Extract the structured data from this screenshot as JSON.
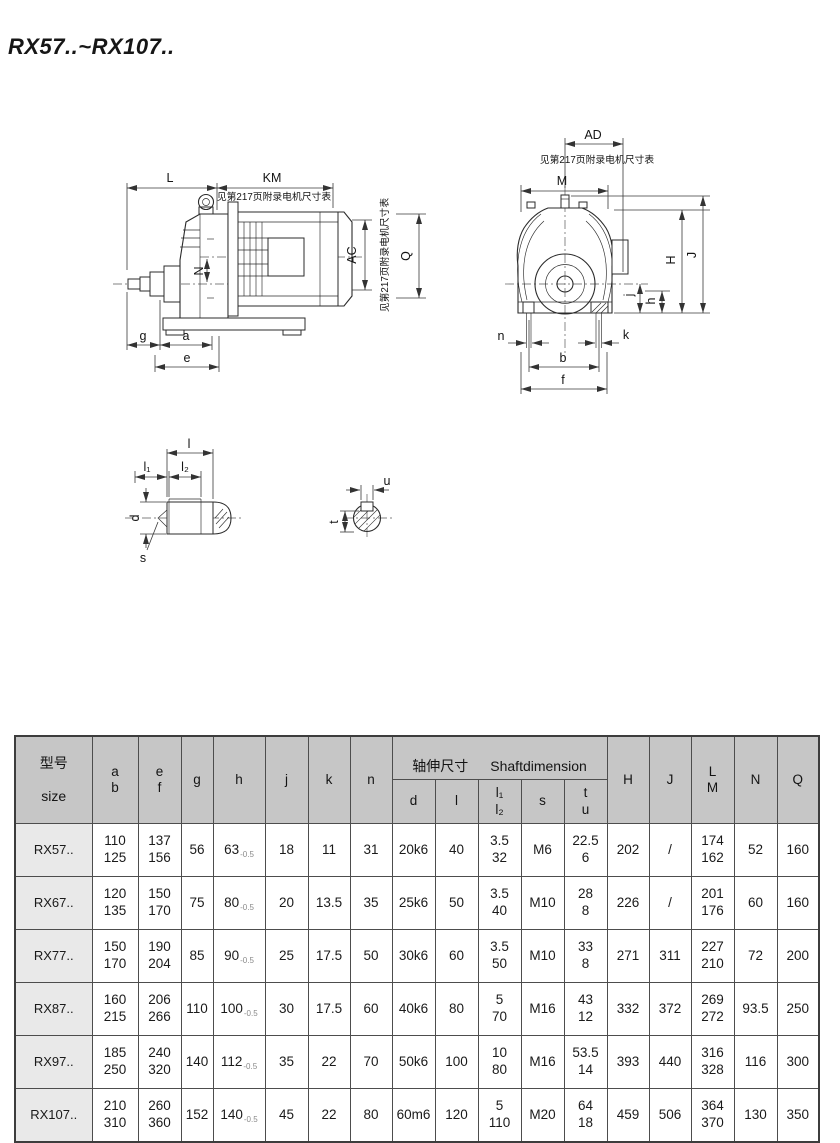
{
  "page": {
    "title": "RX57..~RX107.."
  },
  "drawings": {
    "motor_note": "见第217页附录电机尺寸表",
    "side_view": {
      "L": "L",
      "KM": "KM",
      "N": "N",
      "AC": "AC",
      "Q": "Q",
      "g": "g",
      "a": "a",
      "e": "e"
    },
    "front_view": {
      "AD": "AD",
      "M": "M",
      "H": "H",
      "J": "J",
      "j": "j",
      "h": "h",
      "n": "n",
      "k": "k",
      "b": "b",
      "f": "f"
    },
    "shaft_detail": {
      "l": "l",
      "l1": "l₁",
      "l2": "l₂",
      "d": "d",
      "s": "s"
    },
    "shaft_section": {
      "u": "u",
      "t": "t"
    }
  },
  "table": {
    "header": {
      "size_cn": "型号",
      "size_en": "size",
      "ab": "a\nb",
      "ef": "e\nf",
      "g": "g",
      "h": "h",
      "j": "j",
      "k": "k",
      "n": "n",
      "shaft_group_cn": "轴伸尺寸",
      "shaft_group_en": "Shaftdimension",
      "d": "d",
      "l": "l",
      "l1l2": "l₁\nl₂",
      "s": "s",
      "tu": "t\nu",
      "H": "H",
      "J": "J",
      "LM": "L\nM",
      "N": "N",
      "Q": "Q"
    },
    "rows": [
      {
        "size": "RX57..",
        "ab": "110\n125",
        "ef": "137\n156",
        "g": "56",
        "h": "63",
        "h_tol": "-0.5",
        "j": "18",
        "k": "11",
        "n": "31",
        "d": "20k6",
        "l": "40",
        "l1l2": "3.5\n32",
        "s": "M6",
        "tu": "22.5\n6",
        "H": "202",
        "J": "/",
        "LM": "174\n162",
        "N": "52",
        "Q": "160"
      },
      {
        "size": "RX67..",
        "ab": "120\n135",
        "ef": "150\n170",
        "g": "75",
        "h": "80",
        "h_tol": "-0.5",
        "j": "20",
        "k": "13.5",
        "n": "35",
        "d": "25k6",
        "l": "50",
        "l1l2": "3.5\n40",
        "s": "M10",
        "tu": "28\n8",
        "H": "226",
        "J": "/",
        "LM": "201\n176",
        "N": "60",
        "Q": "160"
      },
      {
        "size": "RX77..",
        "ab": "150\n170",
        "ef": "190\n204",
        "g": "85",
        "h": "90",
        "h_tol": "-0.5",
        "j": "25",
        "k": "17.5",
        "n": "50",
        "d": "30k6",
        "l": "60",
        "l1l2": "3.5\n50",
        "s": "M10",
        "tu": "33\n8",
        "H": "271",
        "J": "311",
        "LM": "227\n210",
        "N": "72",
        "Q": "200"
      },
      {
        "size": "RX87..",
        "ab": "160\n215",
        "ef": "206\n266",
        "g": "110",
        "h": "100",
        "h_tol": "-0.5",
        "j": "30",
        "k": "17.5",
        "n": "60",
        "d": "40k6",
        "l": "80",
        "l1l2": "5\n70",
        "s": "M16",
        "tu": "43\n12",
        "H": "332",
        "J": "372",
        "LM": "269\n272",
        "N": "93.5",
        "Q": "250"
      },
      {
        "size": "RX97..",
        "ab": "185\n250",
        "ef": "240\n320",
        "g": "140",
        "h": "112",
        "h_tol": "-0.5",
        "j": "35",
        "k": "22",
        "n": "70",
        "d": "50k6",
        "l": "100",
        "l1l2": "10\n80",
        "s": "M16",
        "tu": "53.5\n14",
        "H": "393",
        "J": "440",
        "LM": "316\n328",
        "N": "116",
        "Q": "300"
      },
      {
        "size": "RX107..",
        "ab": "210\n310",
        "ef": "260\n360",
        "g": "152",
        "h": "140",
        "h_tol": "-0.5",
        "j": "45",
        "k": "22",
        "n": "80",
        "d": "60m6",
        "l": "120",
        "l1l2": "5\n110",
        "s": "M20",
        "tu": "64\n18",
        "H": "459",
        "J": "506",
        "LM": "364\n370",
        "N": "130",
        "Q": "350"
      }
    ]
  }
}
